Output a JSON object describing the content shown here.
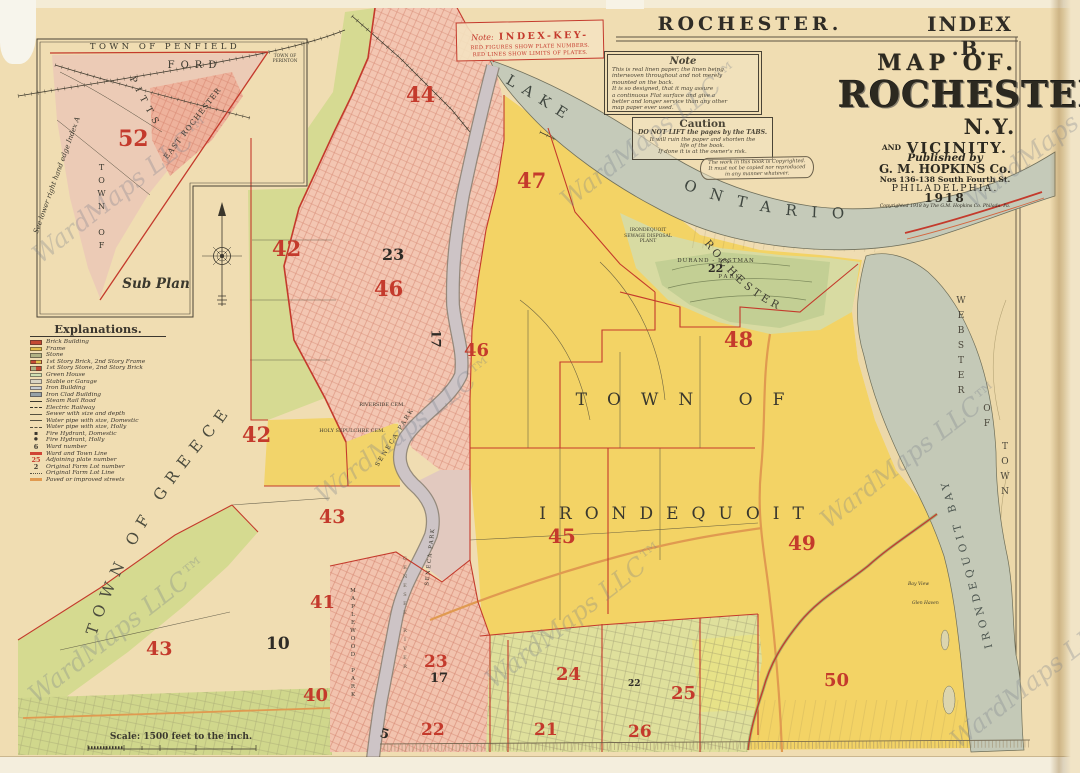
{
  "header": {
    "left": "ROCHESTER.",
    "right": "INDEX .B."
  },
  "index_key": {
    "note": "Note:",
    "title": "INDEX-KEY-",
    "line1": "RED FIGURES SHOW PLATE NUMBERS.",
    "line2": "RED LINES SHOW LIMITS OF PLATES."
  },
  "note_box": {
    "title": "Note",
    "lines": [
      "This is real linen paper; the linen being",
      "interwoven throughout and not merely",
      "mounted on the back.",
      "It is so designed, that it may assure",
      "a continuous Flat surface and give a",
      "better and longer service than any other",
      "map paper ever used."
    ]
  },
  "caution_box": {
    "title": "Caution",
    "bold": "DO NOT LIFT the pages by the TABS.",
    "lines": [
      "It will ruin the paper and shorten the",
      "life of the book.",
      "If done it is at the owner's risk."
    ]
  },
  "copyright_scroll": {
    "lines": [
      "The work in this book is Copyrighted.",
      "It must not be copied nor reproduced",
      "in any manner whatever."
    ]
  },
  "title_block": {
    "map_of": "MAP OF.",
    "city": "ROCHESTER",
    "ny": "N.Y.",
    "and": "AND",
    "vicinity": "VICINITY.",
    "published_by": "Published by",
    "publisher": "G. M. HOPKINS Co.",
    "address": "Nos 136-138 South Fourth St.",
    "phila": "PHILADELPHIA.",
    "year": "1918",
    "copyright": "Copyrighted 1918 by The G.M. Hopkins Co. Philada. Pa."
  },
  "legend": {
    "title": "Explanations.",
    "items": [
      {
        "label": "Brick Building"
      },
      {
        "label": "Frame"
      },
      {
        "label": "Stone"
      },
      {
        "label": "1st Story Brick, 2nd Story Frame"
      },
      {
        "label": "1st Story Stone, 2nd Story Brick"
      },
      {
        "label": "Green House"
      },
      {
        "label": "Stable or Garage"
      },
      {
        "label": "Iron Building"
      },
      {
        "label": "Iron Clad Building"
      },
      {
        "label": "Steam Rail Road"
      },
      {
        "label": "Electric Railway"
      },
      {
        "label": "Sewer with size and depth"
      },
      {
        "label": "Water pipe with size, Domestic"
      },
      {
        "label": "Water pipe with size, Holly"
      },
      {
        "label": "Fire Hydrant, Domestic"
      },
      {
        "label": "Fire Hydrant, Holly"
      },
      {
        "label": "Ward number",
        "sym": "6"
      },
      {
        "label": "Ward and Town Line"
      },
      {
        "label": "Adjoining plate number",
        "sym": "25"
      },
      {
        "label": "Original Farm Lot number",
        "sym": "2"
      },
      {
        "label": "Original Farm Lot Line"
      },
      {
        "label": "Paved or improved streets"
      }
    ]
  },
  "inset": {
    "penfield": "TOWN OF PENFIELD",
    "ford": "FORD",
    "pittsford_vertical": "TOWN OF",
    "pittsford_diag": "PITTS",
    "east_rochester": "EAST ROCHESTER",
    "perinton1": "TOWN OF",
    "perinton2": "PERINTON",
    "sub_plan": "Sub Plan",
    "edge_note": "See lower right hand edge Index A"
  },
  "map_labels": {
    "lake_word": "LAKE",
    "ontario": "ONTARIO",
    "greece": "TOWN OF GREECE",
    "town_of": "TOWN OF",
    "irondequoit": "IRONDEQUOIT",
    "webster_town": "TOWN",
    "webster_of": "OF",
    "webster": "WEBSTER",
    "bay": "IRONDEQUOIT BAY",
    "rochester_city": "ROCHESTER",
    "durand": "DURAND - EASTMAN",
    "durand_park": "PARK",
    "sewage1": "IRONDEQUOIT",
    "sewage2": "SEWAGE DISPOSAL",
    "sewage3": "PLANT",
    "riverside": "RIVERSIDE CEM.",
    "holy_sepulchre": "HOLY SEPULCHRE CEM.",
    "seneca_park": "SENECA PARK",
    "seneca_park2": "SENECA PARK",
    "maplewood": "MAPLEWOOD PARK",
    "genesee": "GENESEE RIVER",
    "bay_view": "Bay View",
    "glen_haven": "Glen Haven"
  },
  "scale_text": "Scale: 1500 feet to the inch.",
  "watermark": "WardMaps LLC™",
  "plates_red": [
    {
      "n": "52"
    },
    {
      "n": "44"
    },
    {
      "n": "47"
    },
    {
      "n": "42"
    },
    {
      "n": "46"
    },
    {
      "n": "46"
    },
    {
      "n": "42"
    },
    {
      "n": "48"
    },
    {
      "n": "43"
    },
    {
      "n": "45"
    },
    {
      "n": "49"
    },
    {
      "n": "43"
    },
    {
      "n": "41"
    },
    {
      "n": "40"
    },
    {
      "n": "50"
    },
    {
      "n": "24"
    },
    {
      "n": "25"
    },
    {
      "n": "23"
    },
    {
      "n": "22"
    },
    {
      "n": "21"
    },
    {
      "n": "26"
    }
  ],
  "wards_black": [
    {
      "n": "23"
    },
    {
      "n": "17"
    },
    {
      "n": "22"
    },
    {
      "n": "10"
    },
    {
      "n": "17"
    },
    {
      "n": "5"
    },
    {
      "n": "22"
    }
  ],
  "colors": {
    "paper": "#f0ddb2",
    "yellow": "#f3d365",
    "green": "#d6da92",
    "pink": "#f3c6b2",
    "water": "#c5cab9",
    "olive": "#dfe09c",
    "red_overprint": "#c43a2c",
    "paved_orange": "#e09a50",
    "ink": "#3a362c"
  }
}
